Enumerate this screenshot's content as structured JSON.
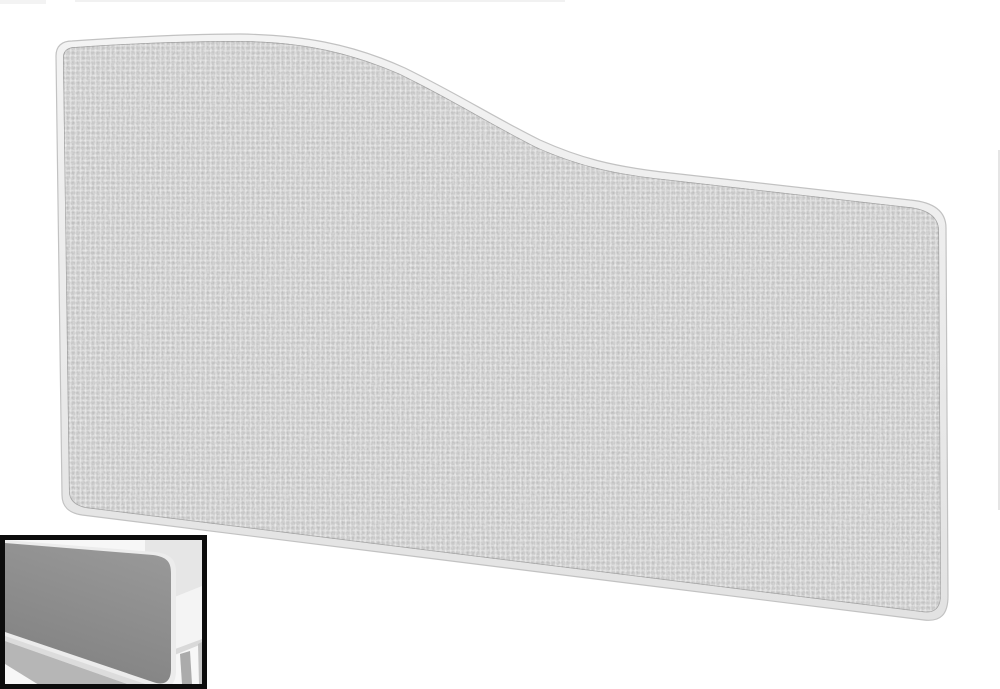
{
  "page": {
    "background": "#ffffff",
    "description": "product photo of a wave-top fabric desk screen with mounted-on-desk inset thumbnail"
  },
  "main_panel": {
    "label": "wave-top fabric desk screen panel",
    "fabric_base": "#c7c7c7",
    "fabric_dark_speckle": "#8a8a8a",
    "fabric_light_speckle": "#f2f2f2",
    "trim_light": "#f3f3f3",
    "trim_dark": "#e2e2e2",
    "outline": "#c2c2c2",
    "seam": "#9e9e9e"
  },
  "inset_thumbnail": {
    "label": "desk screen shown mounted on white desk",
    "border": "#0c0c0c",
    "background": "#f7f7f7",
    "wall": "#e6e6e6",
    "desk_top": "#f4f4f4",
    "desk_edge": "#d9d9d9",
    "desk_leg": "#ababab",
    "desk_leg_far": "#c4c4c4",
    "panel_top": "#989898",
    "panel_bottom": "#818181",
    "panel_trim": "#ececec",
    "floor_band": "#dcdcdc",
    "floor_shadow": "#b6b6b6"
  },
  "artifacts": {
    "right_sliver": "#dedede"
  }
}
